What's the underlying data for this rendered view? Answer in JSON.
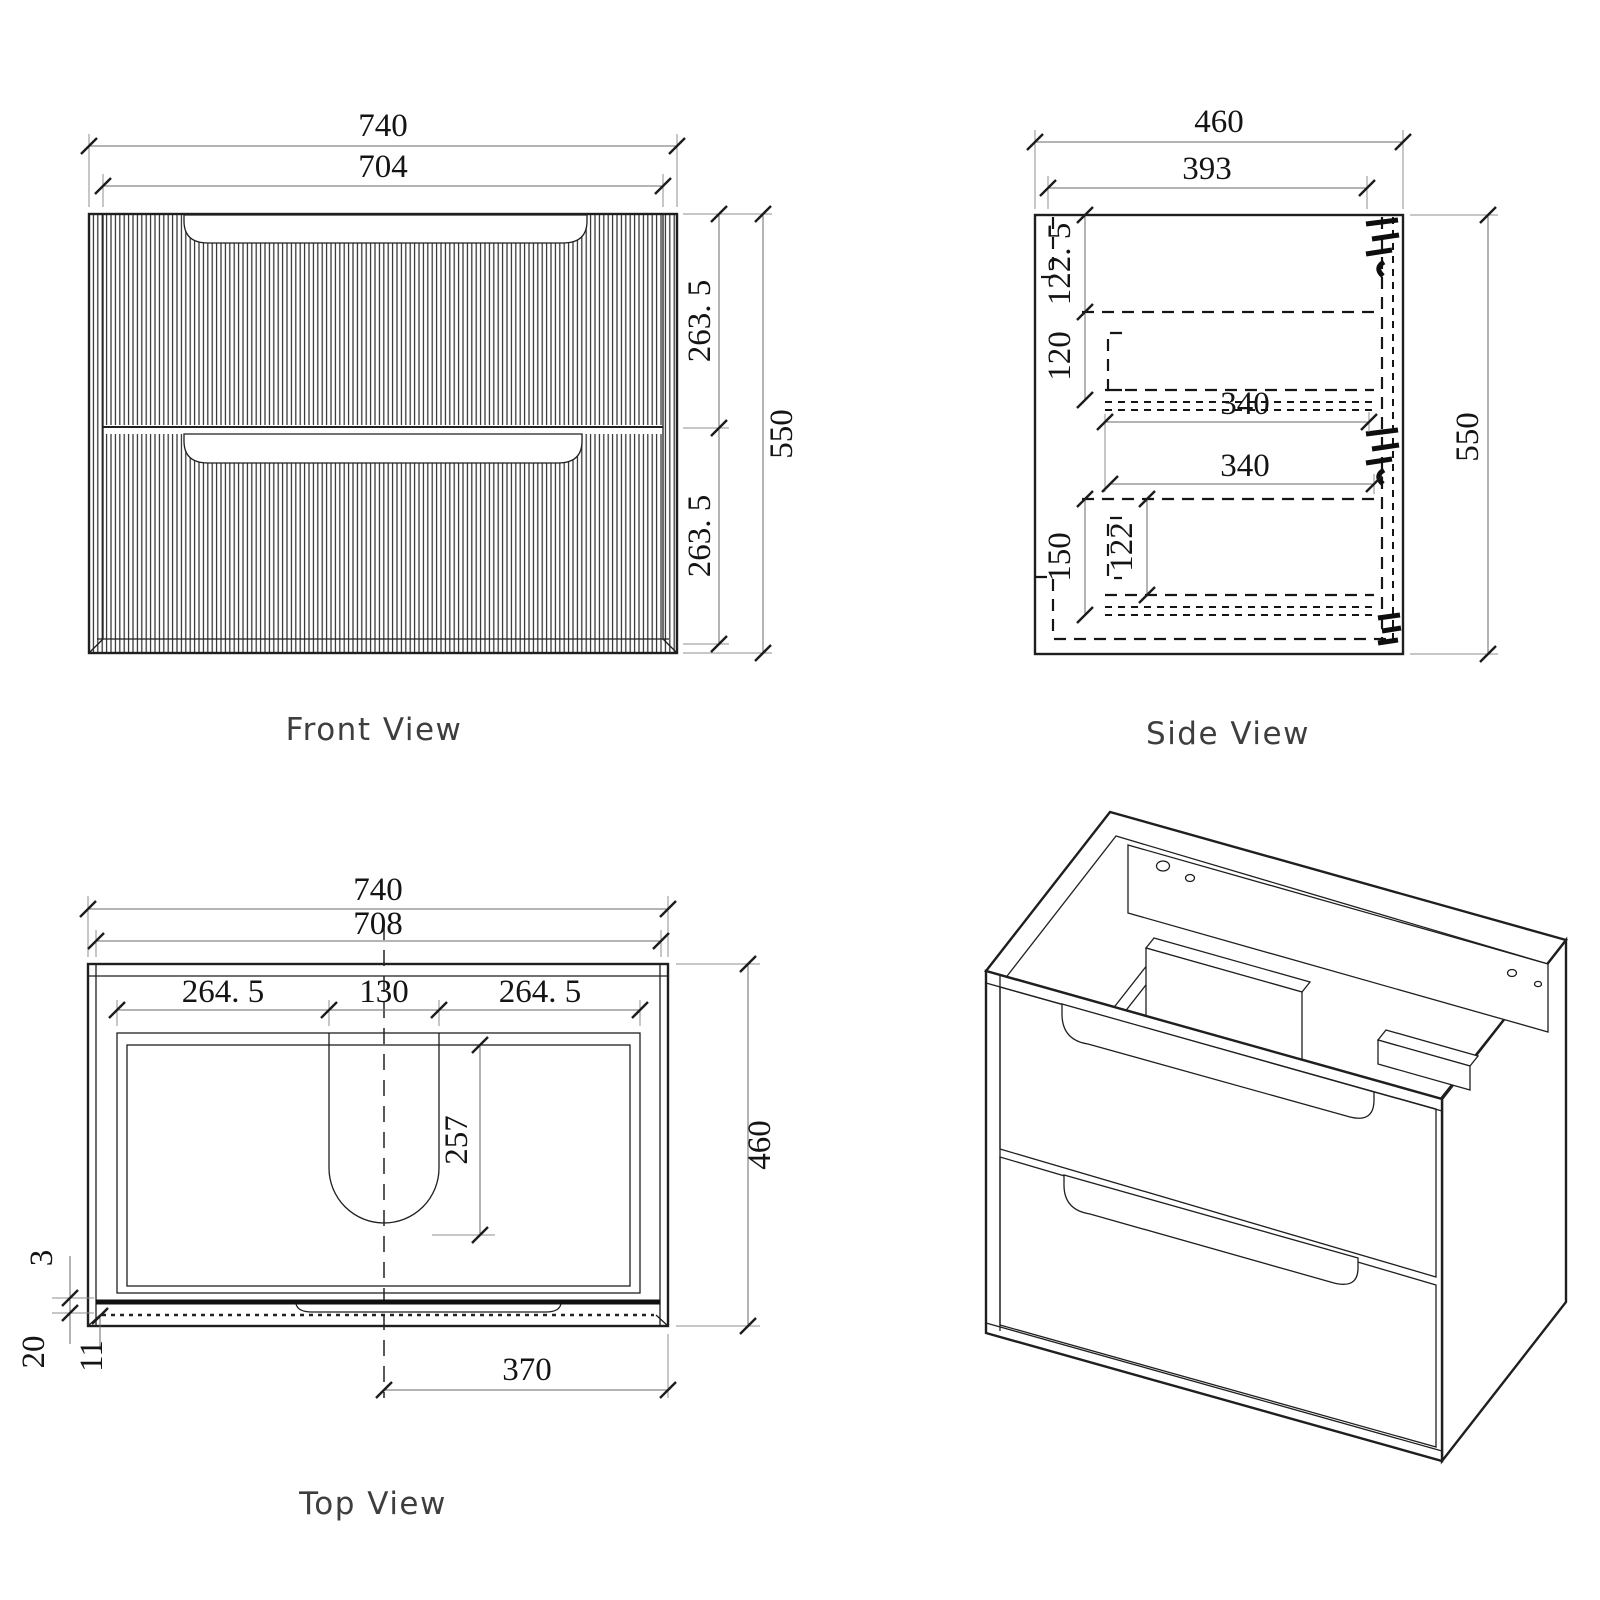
{
  "style": {
    "background": "#ffffff",
    "line_color": "#1f1f1f"
  },
  "views": {
    "front": {
      "label": "Front View",
      "dims": {
        "overall_width": "740",
        "opening_width": "704",
        "upper_drawer_height": "263. 5",
        "lower_drawer_height": "263. 5",
        "overall_height": "550"
      }
    },
    "side": {
      "label": "Side View",
      "dims": {
        "overall_depth": "460",
        "internal_depth": "393",
        "top_clearance": "122. 5",
        "upper_drawer_side": "120",
        "upper_runner": "340",
        "lower_runner": "340",
        "bottom_clearance": "150",
        "lower_drawer_side": "122",
        "overall_height": "550"
      }
    },
    "top": {
      "label": "Top View",
      "dims": {
        "overall_width": "740",
        "internal_width": "708",
        "left_offset": "264. 5",
        "cutout_width": "130",
        "right_offset": "264. 5",
        "cutout_depth": "257",
        "overall_depth": "460",
        "top_gap": "3",
        "front_rail": "20",
        "front_inset": "11",
        "centre_to_side": "370"
      }
    },
    "isometric": {
      "label": ""
    }
  }
}
